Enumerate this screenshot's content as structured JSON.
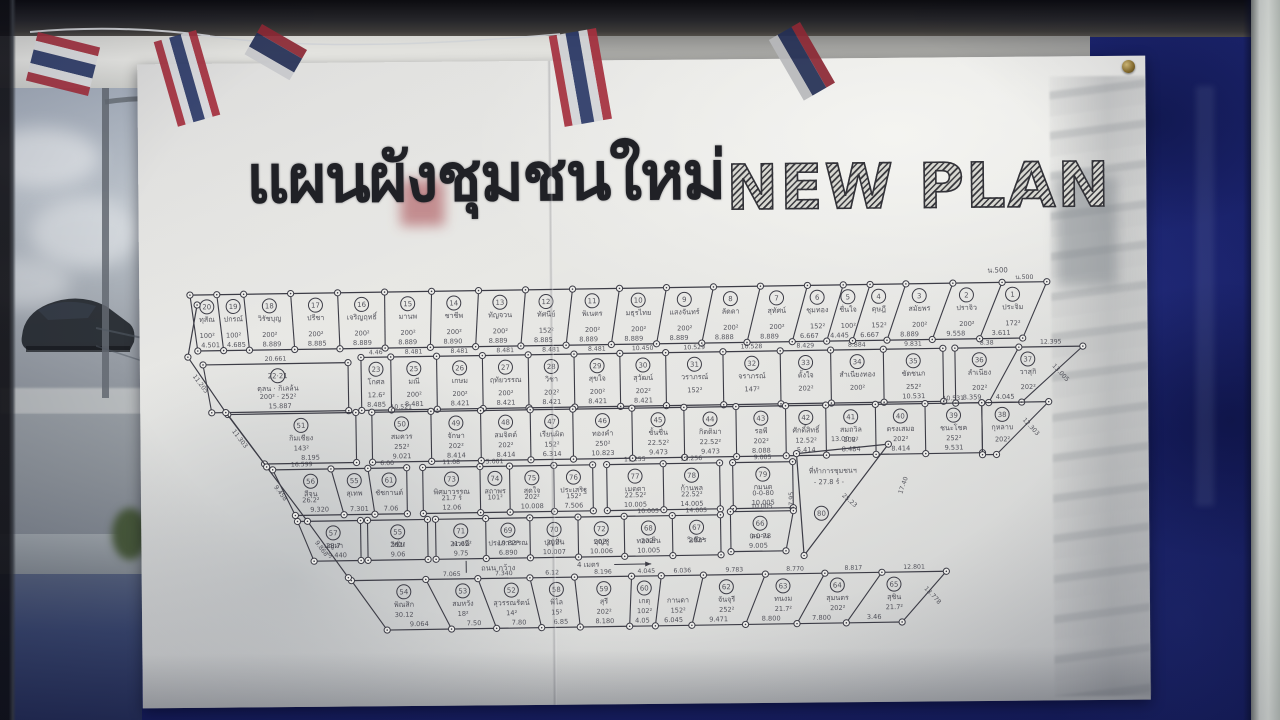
{
  "title": {
    "thai": "แผนผังชุมชนใหม่",
    "english": "NEW PLAN"
  },
  "colors": {
    "board_navy": "#1b2370",
    "paper": "#e9e9e6",
    "ink": "#3c3c46",
    "frame_dark": "#0c0c10",
    "flag_red": "#a5303e",
    "flag_navy": "#2c3a68"
  },
  "map": {
    "corner_note": "น.500",
    "road_label": {
      "text": "ถนน กว้าง",
      "width": "4 เมตร"
    },
    "left_boundary_dims": [
      "11.205",
      "11.303",
      "9.458",
      "9.868"
    ],
    "office": {
      "name": "ที่ทำการชุมชนฯ",
      "area": "- 27.8 ร์ -",
      "n": "80",
      "top": "13.00 ม.",
      "left": "17.95",
      "slant": "25.23",
      "side": "17.40"
    },
    "segments": [
      {
        "y0": 30,
        "y1": 86,
        "tx0": 48,
        "tx1": 905,
        "bx0": 55,
        "bx1": 880,
        "wts": [
          24,
          24,
          42,
          42,
          42,
          42,
          42,
          42,
          42,
          42,
          42,
          42,
          42,
          42,
          32,
          24,
          32,
          42,
          44,
          40
        ],
        "plots": [
          {
            "n": "20",
            "name": "ทุสัณ",
            "area": "100²",
            "dim": "4.501"
          },
          {
            "n": "19",
            "name": "ปกรณ์",
            "area": "100²",
            "dim": "4.685"
          },
          {
            "n": "18",
            "name": "วิรัชบุญ",
            "area": "200²",
            "dim": "8.889"
          },
          {
            "n": "17",
            "name": "ปรีชา",
            "area": "200²",
            "dim": "8.885"
          },
          {
            "n": "16",
            "name": "เจริญฤทธิ์",
            "area": "200²",
            "dim": "8.889"
          },
          {
            "n": "15",
            "name": "มานพ",
            "area": "200²",
            "dim": "8.889"
          },
          {
            "n": "14",
            "name": "ชาชีพ",
            "area": "200²",
            "dim": "8.890"
          },
          {
            "n": "13",
            "name": "ทัญจวน",
            "area": "200²",
            "dim": "8.889"
          },
          {
            "n": "12",
            "name": "ทัศนีย์",
            "area": "152²",
            "dim": "8.885"
          },
          {
            "n": "11",
            "name": "พิเนตร",
            "area": "200²",
            "dim": "8.889"
          },
          {
            "n": "10",
            "name": "มธุรไทย",
            "area": "200²",
            "dim": "8.889"
          },
          {
            "n": "9",
            "name": "แสงจันทร์",
            "area": "200²",
            "dim": "8.889"
          },
          {
            "n": "8",
            "name": "ลัดดา",
            "area": "200²",
            "dim": "8.888"
          },
          {
            "n": "7",
            "name": "สุทัศน์",
            "area": "200²",
            "dim": "8.889"
          },
          {
            "n": "6",
            "name": "ชุมทอง",
            "area": "152²",
            "dim": "6.667"
          },
          {
            "n": "5",
            "name": "ชื่นใจ",
            "area": "100²",
            "dim": "4.445"
          },
          {
            "n": "4",
            "name": "ดุษฎี",
            "area": "152²",
            "dim": "6.667"
          },
          {
            "n": "3",
            "name": "สมัยพร",
            "area": "200²",
            "dim": "8.889"
          },
          {
            "n": "2",
            "name": "ปราจิว",
            "area": "200²",
            "dim": "9.558"
          },
          {
            "n": "1",
            "name": "ประจิม",
            "area": "172²",
            "dim": "3.611",
            "top": "น.500"
          }
        ]
      },
      {
        "y0": 100,
        "y1": 148,
        "tx0": 60,
        "tx1": 205,
        "bx0": 68,
        "bx1": 205,
        "plots": [
          {
            "n": "22·21",
            "name": "ดุลน · กิเลล้น",
            "area": "200² · 252²",
            "dim": "15.887",
            "top": "20.661"
          }
        ]
      },
      {
        "y0": 95,
        "y1": 148,
        "tx0": 218,
        "tx1": 800,
        "bx0": 218,
        "bx1": 800,
        "wts": [
          26,
          40,
          40,
          40,
          40,
          40,
          40,
          50,
          50,
          44,
          46,
          52
        ],
        "plots": [
          {
            "n": "23",
            "name": "โกศล",
            "area": "12.6²",
            "dim": "8.485",
            "top": "4.46"
          },
          {
            "n": "25",
            "name": "มณี",
            "area": "200²",
            "dim": "8.481",
            "top": "8.481"
          },
          {
            "n": "26",
            "name": "เกษม",
            "area": "200²",
            "dim": "8.421",
            "top": "8.481"
          },
          {
            "n": "27",
            "name": "ฤทัยวรรณ",
            "area": "200²",
            "dim": "8.421",
            "top": "8.481"
          },
          {
            "n": "28",
            "name": "วิชา",
            "area": "202²",
            "dim": "8.421",
            "top": "8.481"
          },
          {
            "n": "29",
            "name": "สุขใจ",
            "area": "200²",
            "dim": "8.421",
            "top": "8.481"
          },
          {
            "n": "30",
            "name": "สุวัฒน์",
            "area": "202²",
            "dim": "8.421",
            "top": "10.450"
          },
          {
            "n": "31",
            "name": "วราภรณ์",
            "area": "152²",
            "dim": "",
            "top": "10.529"
          },
          {
            "n": "32",
            "name": "จราภรณ์",
            "area": "147²",
            "dim": "",
            "top": "10.528"
          },
          {
            "n": "33",
            "name": "ตั้งใจ",
            "area": "202²",
            "dim": "",
            "top": "8.429"
          },
          {
            "n": "34",
            "name": "สำเนียงทอง",
            "area": "200²",
            "dim": "",
            "top": "8.884"
          },
          {
            "n": "35",
            "name": "ชัดชนก",
            "area": "252²",
            "dim": "10.531",
            "top": "9.831"
          }
        ]
      },
      {
        "y0": 95,
        "y1": 150,
        "tx0": 812,
        "tx1": 940,
        "bx0": 812,
        "bx1": 878,
        "slant": "13.005",
        "plots": [
          {
            "n": "36",
            "name": "ลำเนียง",
            "area": "202²",
            "dim": "8.359",
            "top": "8.38"
          },
          {
            "n": "37",
            "name": "วาสุกิ",
            "area": "202²",
            "dim": "4.045",
            "top": "12.395"
          }
        ]
      },
      {
        "y0": 150,
        "y1": 200,
        "tx0": 84,
        "tx1": 212,
        "bx0": 120,
        "bx1": 212,
        "plots": [
          {
            "n": "51",
            "name": "กิมเชียง",
            "area": "143²",
            "dim": "8.195"
          }
        ]
      },
      {
        "y0": 150,
        "y1": 200,
        "tx0": 228,
        "tx1": 838,
        "bx0": 228,
        "bx1": 838,
        "wts": [
          50,
          42,
          42,
          36,
          50,
          44,
          44,
          42,
          34,
          42,
          42,
          48
        ],
        "plots": [
          {
            "n": "50",
            "name": "สมควร",
            "area": "252²",
            "dim": "9.021",
            "top": "10.521"
          },
          {
            "n": "49",
            "name": "จักษา",
            "area": "202²",
            "dim": "8.414"
          },
          {
            "n": "48",
            "name": "สมจิตต์",
            "area": "202²",
            "dim": "8.414"
          },
          {
            "n": "47",
            "name": "เรียนผิต",
            "area": "152²",
            "dim": "6.314"
          },
          {
            "n": "46",
            "name": "ทองคำ",
            "area": "250²",
            "dim": "10.823"
          },
          {
            "n": "45",
            "name": "ชั้นชื่น",
            "area": "22.52²",
            "dim": "9.473"
          },
          {
            "n": "44",
            "name": "กิตติมา",
            "area": "22.52²",
            "dim": "9.473"
          },
          {
            "n": "43",
            "name": "รอพี",
            "area": "202²",
            "dim": "8.088"
          },
          {
            "n": "42",
            "name": "ศักดิ์สิทธิ์",
            "area": "12.52²",
            "dim": "5.414"
          },
          {
            "n": "41",
            "name": "สมถวิล",
            "area": "202²",
            "dim": "8.484"
          },
          {
            "n": "40",
            "name": "ตรงเสมอ",
            "area": "202²",
            "dim": "8.414"
          },
          {
            "n": "39",
            "name": "ชนะโชค",
            "area": "252²",
            "dim": "9.531",
            "top": "10.531"
          }
        ]
      },
      {
        "y0": 150,
        "y1": 202,
        "tx0": 838,
        "tx1": 905,
        "bx0": 838,
        "bx1": 852,
        "slant": "12.303",
        "plots": [
          {
            "n": "38",
            "name": "กุหลาบ",
            "area": "202²",
            "dim": ""
          }
        ]
      },
      {
        "y0": 206,
        "y1": 252,
        "tx0": 128,
        "tx1": 262,
        "bx0": 150,
        "bx1": 262,
        "wts": [
          60,
          38,
          40
        ],
        "plots": [
          {
            "n": "56",
            "name": "สีจุน",
            "area": "26.2²",
            "dim": "9.320",
            "top": "16.599"
          },
          {
            "n": "55",
            "name": "สุเทพ",
            "area": "",
            "dim": "7.301"
          },
          {
            "n": "61",
            "name": "ชัชกานต์",
            "area": "",
            "dim": "7.06",
            "top": "6.00"
          }
        ]
      },
      {
        "y0": 206,
        "y1": 252,
        "tx0": 278,
        "tx1": 448,
        "bx0": 278,
        "bx1": 448,
        "wts": [
          62,
          32,
          48,
          42
        ],
        "plots": [
          {
            "n": "73",
            "name": "พิศมาวรรณ",
            "area": "21.7 ร์",
            "dim": "12.06",
            "top": "11.08"
          },
          {
            "n": "74",
            "name": "สถาพร",
            "area": "101²",
            "dim": "",
            "top": "5.001"
          },
          {
            "n": "75",
            "name": "สุดใจ",
            "area": "202²",
            "dim": "10.008"
          },
          {
            "n": "76",
            "name": "ประเสริฐ",
            "area": "152²",
            "dim": "7.506"
          }
        ]
      },
      {
        "y0": 206,
        "y1": 252,
        "tx0": 462,
        "tx1": 575,
        "bx0": 462,
        "bx1": 575,
        "plots": [
          {
            "n": "77",
            "name": "เมตตา",
            "area": "22.52²",
            "dim": "10.005",
            "top": "11.255"
          },
          {
            "n": "78",
            "name": "ก้านพล",
            "area": "22.52²",
            "dim": "14.005",
            "top": "11.256"
          }
        ]
      },
      {
        "y0": 206,
        "y1": 252,
        "tx0": 588,
        "tx1": 648,
        "bx0": 588,
        "bx1": 648,
        "plots": [
          {
            "n": "79",
            "name": "กมนต",
            "area": "0-0-80",
            "dim": "10.005",
            "top": "9.005"
          }
        ]
      },
      {
        "y0": 258,
        "y1": 298,
        "tx0": 152,
        "tx1": 215,
        "bx0": 168,
        "bx1": 215,
        "plots": [
          {
            "n": "57",
            "name": "บุญมา",
            "area": "28.7",
            "dim": "9.440"
          }
        ]
      },
      {
        "y0": 258,
        "y1": 298,
        "tx0": 222,
        "tx1": 282,
        "bx0": 222,
        "bx1": 282,
        "plots": [
          {
            "n": "55",
            "name": "วิชั่น",
            "area": "202²",
            "dim": "9.06"
          }
        ]
      },
      {
        "y0": 258,
        "y1": 298,
        "tx0": 290,
        "tx1": 575,
        "bx0": 290,
        "bx1": 575,
        "wts": [
          50,
          44,
          48,
          46,
          48,
          48
        ],
        "plots": [
          {
            "n": "71",
            "name": "พวงนี",
            "area": "21.62²",
            "dim": "9.75"
          },
          {
            "n": "69",
            "name": "ประภาวรรณ",
            "area": "19.82²",
            "dim": "6.890"
          },
          {
            "n": "70",
            "name": "บุญปั่น",
            "area": "202²",
            "dim": "10.007"
          },
          {
            "n": "72",
            "name": "บุญชู",
            "area": "202²",
            "dim": "10.006"
          },
          {
            "n": "68",
            "name": "ทองเย็น",
            "area": "202²",
            "dim": "10.005",
            "top": "10.005"
          },
          {
            "n": "67",
            "name": "วิเชียร",
            "area": "202²",
            "dim": "",
            "top": "14.005"
          }
        ]
      },
      {
        "y0": 255,
        "y1": 295,
        "tx0": 585,
        "tx1": 648,
        "bx0": 585,
        "bx1": 640,
        "plots": [
          {
            "n": "66",
            "name": "สมาน",
            "area": "0-0-78",
            "dim": "9.005",
            "top": "10.005"
          }
        ]
      },
      {
        "y0": 318,
        "y1": 368,
        "tx0": 205,
        "tx1": 800,
        "bx0": 240,
        "bx1": 755,
        "slant": "13.778",
        "wts": [
          60,
          42,
          42,
          36,
          46,
          24,
          34,
          50,
          48,
          46,
          52
        ],
        "plots": [
          {
            "n": "54",
            "name": "พิณสิก",
            "area": "30.12",
            "dim": "9.064"
          },
          {
            "n": "53",
            "name": "สมหวัง",
            "area": "18²",
            "dim": "7.50",
            "top": "7.065"
          },
          {
            "n": "52",
            "name": "สุวรรณรัตน์",
            "area": "14²",
            "dim": "7.80",
            "top": "7.340"
          },
          {
            "n": "58",
            "name": "พิไล",
            "area": "15²",
            "dim": "6.85",
            "top": "6.12"
          },
          {
            "n": "59",
            "name": "สุรี",
            "area": "202²",
            "dim": "8.180",
            "top": "8.196"
          },
          {
            "n": "60",
            "name": "เกตุ",
            "area": "102²",
            "dim": "4.05",
            "top": "4.045"
          },
          {
            "n": "",
            "name": "กานดา",
            "area": "152²",
            "dim": "6.045",
            "top": "6.036"
          },
          {
            "n": "62",
            "name": "จันจุรี",
            "area": "252²",
            "dim": "9.471",
            "top": "9.783"
          },
          {
            "n": "63",
            "name": "ทนงม",
            "area": "21.7²",
            "dim": "8.800",
            "top": "8.770"
          },
          {
            "n": "64",
            "name": "สุมนตร",
            "area": "202²",
            "dim": "7.800",
            "top": "8.817"
          },
          {
            "n": "65",
            "name": "สุชิน",
            "area": "21.7²",
            "dim": "3.46",
            "top": "12.801"
          }
        ]
      }
    ]
  }
}
